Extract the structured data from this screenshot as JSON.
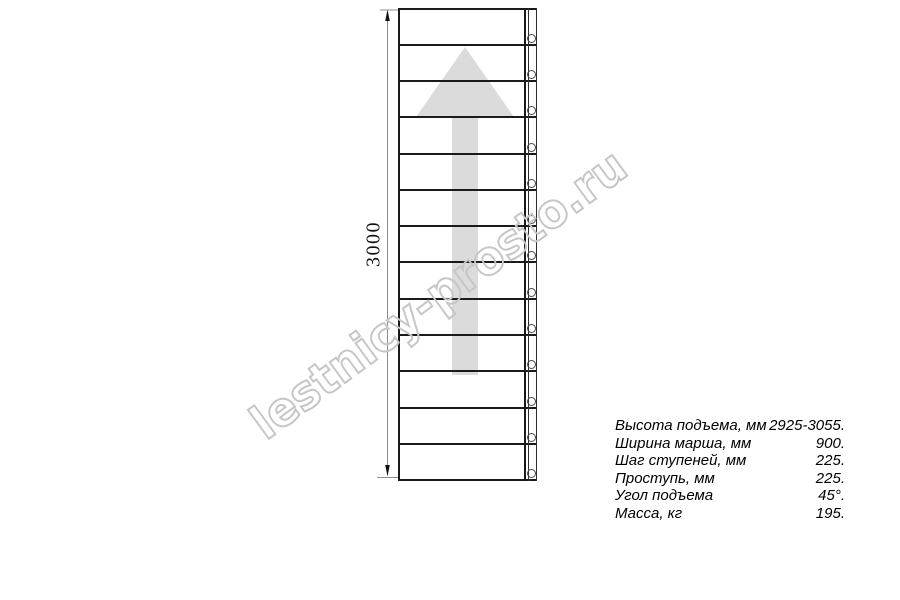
{
  "drawing": {
    "title": "straight-stair-flight-plan-view",
    "dimension": {
      "label": "3000"
    },
    "stairs": {
      "treads": 13,
      "bolt_holes": 13
    },
    "colors": {
      "line": "#1a1a1a",
      "direction_arrow": "#dbdbdb",
      "dimension_line": "#8c8c8c",
      "watermark": "#c6c6c6"
    }
  },
  "watermark": {
    "text": "lestnicy-prosto.ru"
  },
  "specs": {
    "rows": [
      {
        "label": "Высота подъема, мм",
        "value": "2925-3055."
      },
      {
        "label": "Ширина марша, мм",
        "value": "900."
      },
      {
        "label": "Шаг ступеней, мм",
        "value": "225."
      },
      {
        "label": "Проступь, мм",
        "value": "225."
      },
      {
        "label": "Угол подъема",
        "value": "45°."
      },
      {
        "label": "Масса, кг",
        "value": "195."
      }
    ]
  }
}
